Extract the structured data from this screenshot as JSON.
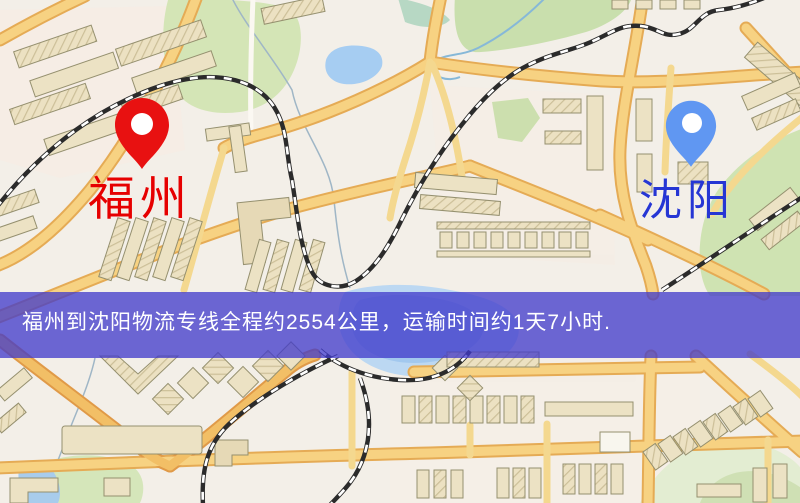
{
  "route_map": {
    "origin": {
      "name": "福州",
      "label_color": "#e60000",
      "pin_color": "#e81111",
      "pin_icon": "map-pin-icon"
    },
    "destination": {
      "name": "沈阳",
      "label_color": "#2636d4",
      "pin_color": "#6097f2",
      "pin_icon": "map-pin-icon"
    },
    "banner": {
      "text": "福州到沈阳物流专线全程约2554公里，运输时间约1天7小时.",
      "distance_km": "2554",
      "duration": "1天7小时",
      "bg_color": "#403acb",
      "text_color": "#ffffff"
    }
  }
}
